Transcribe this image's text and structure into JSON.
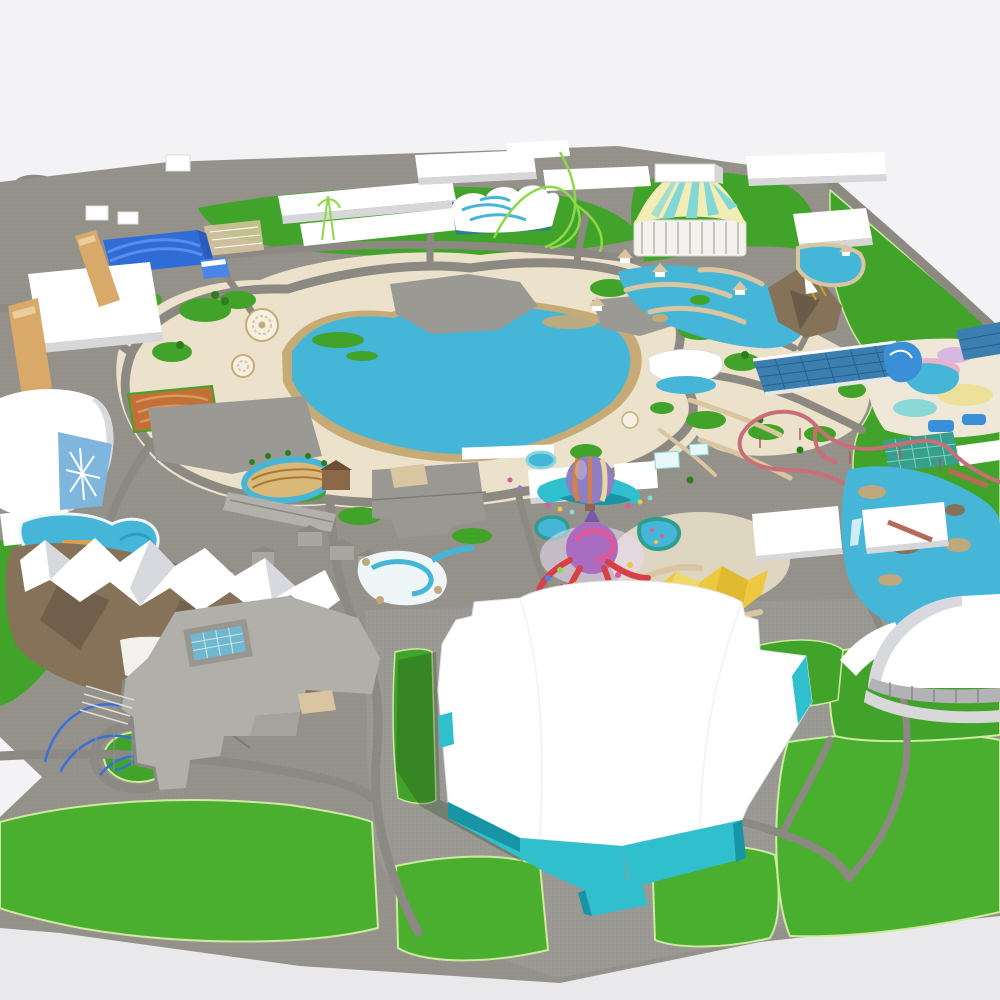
{
  "scene": {
    "type": "3d-theme-park-model-aerial-render",
    "view": "isometric-aerial"
  },
  "palette": {
    "bg_top": "#f3f2f4",
    "bg_bottom": "#e9e9eb",
    "plane_gray": "#94928a",
    "road_gray": "#8b8982",
    "plaza_gray": "#9b9993",
    "texture_dot": "#7e7c76",
    "path_cream": "#ece2cb",
    "path_tan": "#d9c6a0",
    "sand": "#c7ab77",
    "grass": "#42a32a",
    "grass_bright": "#4aae2f",
    "grass_dark": "#2e7d1f",
    "lawn_outline": "#cdeaa0",
    "water": "#45b6d8",
    "water_deep": "#2e9ec4",
    "pool_rim_teal": "#2e9e8e",
    "white": "#ffffff",
    "building_shadow": "#d7d7da",
    "roof_blue": "#2f6cd6",
    "roof_blue_light": "#5b8cee",
    "roof_blue_dark": "#2a5cc0",
    "glass_blue": "#7fb6de",
    "glass_roof": "#3b7fb0",
    "glass_grid": "#2a5f8a",
    "tent_cream": "#f1edb5",
    "tent_cyan": "#84d7d7",
    "teal_wall": "#30bfcc",
    "teal_wall_dark": "#1795a5",
    "greenhouse_teal": "#37a08c",
    "greenhouse_grid": "#7fd0bc",
    "coaster_pink": "#c96e78",
    "coaster_blue": "#3a6fd8",
    "coaster_green": "#8ed84a",
    "balloon_purple": "#8f7fc0",
    "balloon_orange": "#d08048",
    "balloon_cream": "#e8d8a0",
    "octopus_purple": "#a86cc0",
    "octopus_pink": "#e05898",
    "octopus_red": "#d84048",
    "star_yellow": "#ecc93e",
    "star_yellow_light": "#f4dc74",
    "star_yellow_dark": "#d8b028",
    "maze_orange": "#c07038",
    "maze_orange_light": "#dc9858",
    "tan_building": "#d9a96a",
    "mountain_rock": "#867258",
    "mountain_rock_dark": "#6a5a48",
    "snow_shade": "#d8d9de",
    "rock_tan": "#c0a87e",
    "dome_window": "#b3b3b6",
    "deck_pink": "#e8a8c8",
    "deck_yellow": "#ece09a",
    "deck_cyan": "#8ad8d8",
    "deck_lilac": "#d8b8e0",
    "slide_blue": "#3a8fd8",
    "gray_roof": "#a8a6a0",
    "gray_roof_dark": "#8a8880",
    "complex_roof": "#b0afa9",
    "track_dirt": "#d9b878",
    "track_stripe": "#a87838",
    "barn_brown": "#8a6848",
    "gold": "#c8a030"
  },
  "landmarks": [
    "entrance-access-road",
    "backstage-warehouses",
    "blue-arched-hall",
    "maintenance-hall",
    "ice-dome-pavilion",
    "orange-maze-garden",
    "central-lake",
    "lake-dock",
    "north-plaza",
    "wave-pool-building",
    "green-coaster",
    "circus-big-top",
    "lagoon-water-ride",
    "pirate-rock",
    "northeast-pavilion-pond",
    "indoor-waterpark-glass-roof",
    "waterslide-deck",
    "greenhouse",
    "pink-mine-coaster",
    "rapids-river",
    "village-and-race-track",
    "twin-swimming-pools",
    "central-showbuilding",
    "log-flume",
    "balloon-pavilion",
    "octopus-ride",
    "rim-ponds",
    "star-canopy",
    "snow-mountain",
    "mountain-coaster",
    "southwest-complex",
    "skylight-pool",
    "giant-showbuilding-teal-walls",
    "southeast-dome",
    "south-lawns",
    "ring-roads"
  ]
}
